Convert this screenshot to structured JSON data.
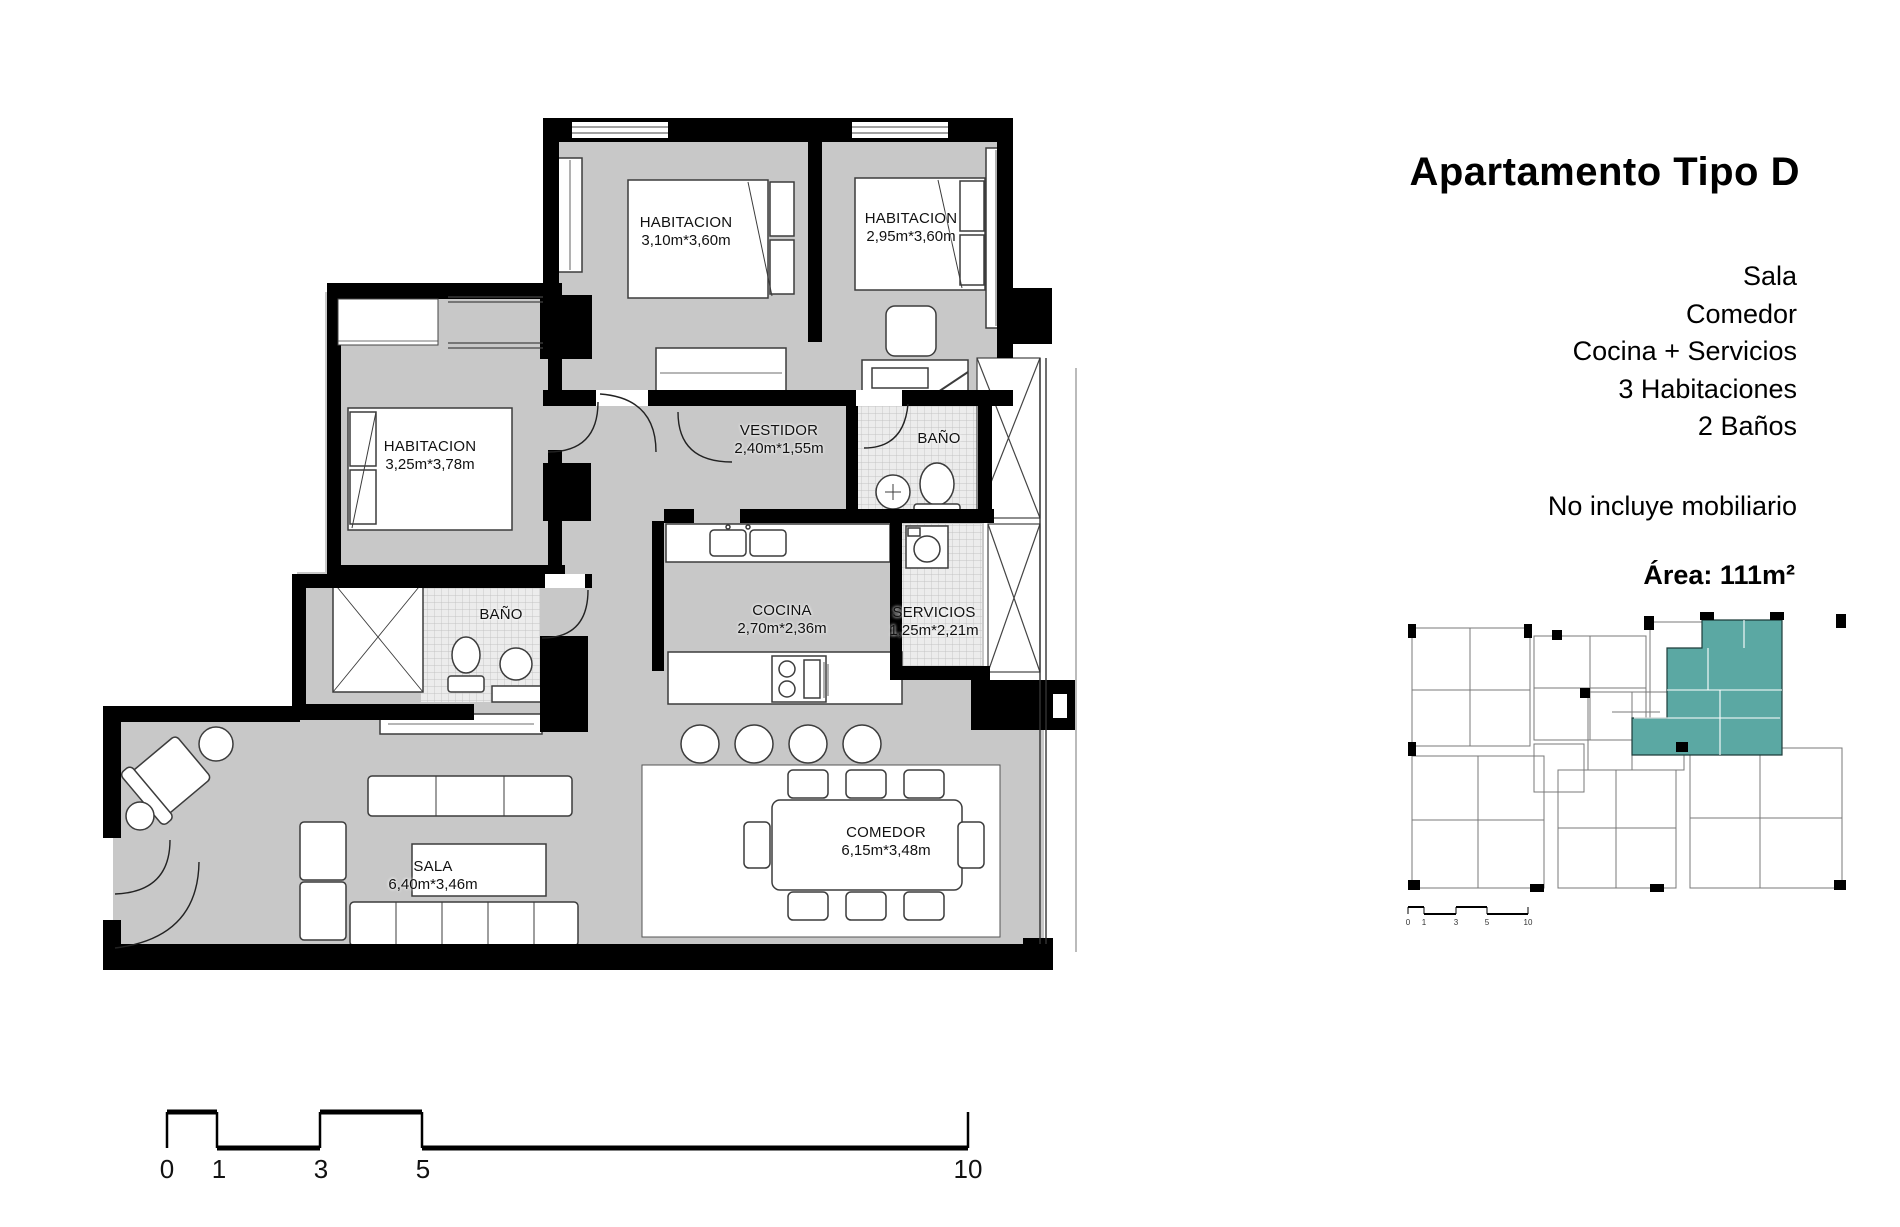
{
  "panel": {
    "title": "Apartamento Tipo D",
    "features": [
      "Sala",
      "Comedor",
      "Cocina + Servicios",
      "3 Habitaciones",
      "2 Baños"
    ],
    "note": "No incluye mobiliario",
    "area": "Área: 111m²"
  },
  "plan": {
    "rooms": [
      {
        "id": "habitacion-1",
        "name": "HABITACION",
        "dims": "3,10m*3,60m"
      },
      {
        "id": "habitacion-2",
        "name": "HABITACION",
        "dims": "2,95m*3,60m"
      },
      {
        "id": "habitacion-3",
        "name": "HABITACION",
        "dims": "3,25m*3,78m"
      },
      {
        "id": "vestidor",
        "name": "VESTIDOR",
        "dims": "2,40m*1,55m"
      },
      {
        "id": "bano-top",
        "name": "BAÑO",
        "dims": ""
      },
      {
        "id": "bano-left",
        "name": "BAÑO",
        "dims": ""
      },
      {
        "id": "cocina",
        "name": "COCINA",
        "dims": "2,70m*2,36m"
      },
      {
        "id": "servicios",
        "name": "SERVICIOS",
        "dims": "1,25m*2,21m"
      },
      {
        "id": "sala",
        "name": "SALA",
        "dims": "6,40m*3,46m"
      },
      {
        "id": "comedor",
        "name": "COMEDOR",
        "dims": "6,15m*3,48m"
      }
    ],
    "scale_labels": [
      "0",
      "1",
      "3",
      "5",
      "10"
    ]
  },
  "keyplan": {
    "scale_labels": [
      "0",
      "1",
      "3",
      "5",
      "10"
    ],
    "highlight_color": "#5ba8a3"
  },
  "colors": {
    "floor": "#c8c8c8",
    "wall": "#000000",
    "tile_background": "#ececec",
    "highlight": "#5ba8a3"
  }
}
